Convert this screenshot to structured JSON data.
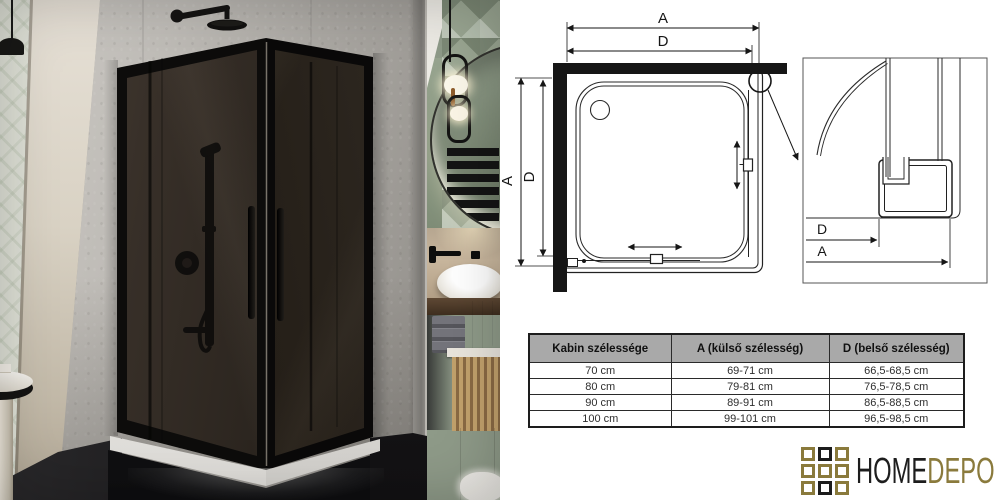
{
  "diagram": {
    "label_a": "A",
    "label_d": "D",
    "meaning_a": "külső szélesség (outer width)",
    "meaning_d": "belső szélesség (inner width)"
  },
  "table": {
    "headers": [
      "Kabin szélessége",
      "A (külső szélesség)",
      "D (belső szélesség)"
    ],
    "rows": [
      [
        "70 cm",
        "69-71 cm",
        "66,5-68,5 cm"
      ],
      [
        "80 cm",
        "79-81 cm",
        "76,5-78,5 cm"
      ],
      [
        "90 cm",
        "89-91 cm",
        "86,5-88,5 cm"
      ],
      [
        "100 cm",
        "99-101 cm",
        "96,5-98,5 cm"
      ]
    ]
  },
  "logo": {
    "home": "HOME",
    "depo": "DEPO",
    "gold": "#8a7a3c",
    "dark": "#1c1c1c",
    "grid_pattern": [
      [
        "gold",
        "black",
        "gold"
      ],
      [
        "gold",
        "gold",
        "gold"
      ],
      [
        "gold",
        "black",
        "gold"
      ]
    ]
  }
}
